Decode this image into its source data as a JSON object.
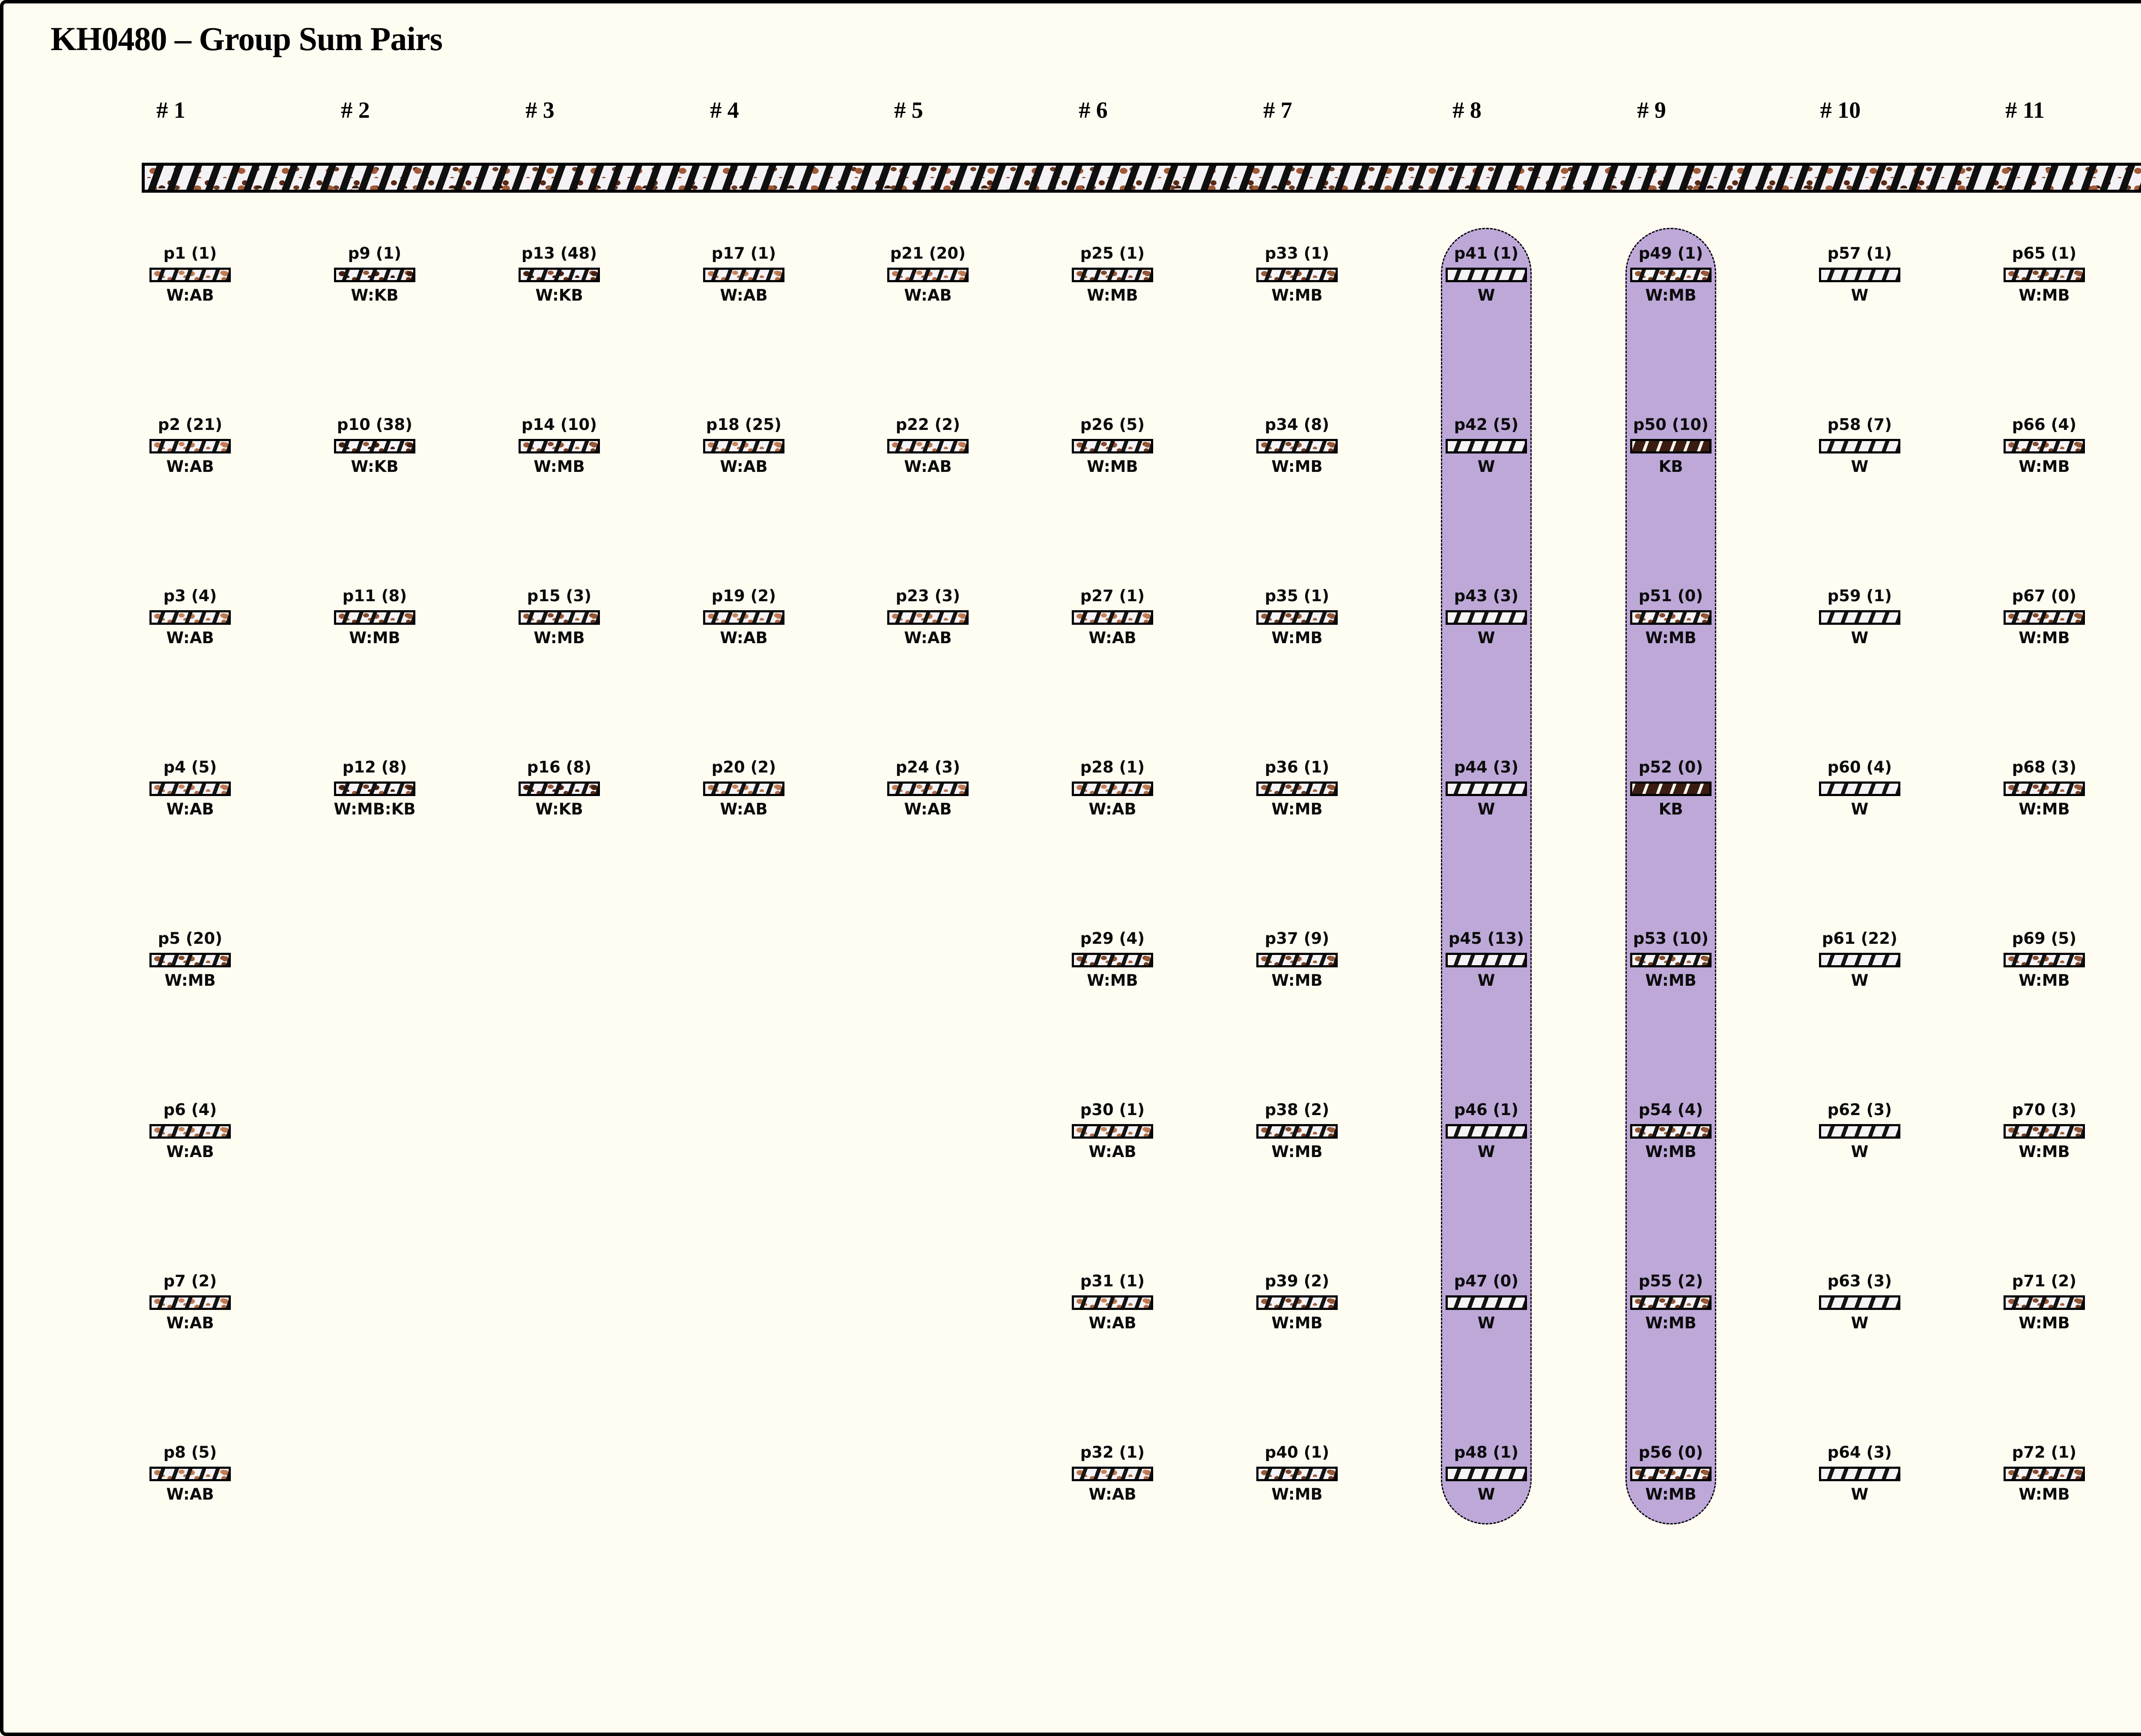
{
  "title": "KH0480 – Group Sum Pairs",
  "colors": {
    "canvas_background": "#fffdf2",
    "highlight_column": "#bda8d8",
    "kb_fill": "#3a1c10",
    "ab_spot": "#bf7a52",
    "mb_spot": "#9a5936",
    "kb_spot": "#4a2212",
    "faded_fill": "#fcefe7",
    "faded_text": "#c9c3ae"
  },
  "columns": [
    {
      "header": "# 1",
      "highlighted": false,
      "items": [
        {
          "label": "p1 (1)",
          "tag": "W:AB",
          "faded": false
        },
        {
          "label": "p2 (21)",
          "tag": "W:AB",
          "faded": false
        },
        {
          "label": "p3 (4)",
          "tag": "W:AB",
          "faded": false
        },
        {
          "label": "p4 (5)",
          "tag": "W:AB",
          "faded": false
        },
        {
          "label": "p5 (20)",
          "tag": "W:MB",
          "faded": false
        },
        {
          "label": "p6 (4)",
          "tag": "W:AB",
          "faded": false
        },
        {
          "label": "p7 (2)",
          "tag": "W:AB",
          "faded": false
        },
        {
          "label": "p8 (5)",
          "tag": "W:AB",
          "faded": false
        }
      ]
    },
    {
      "header": "# 2",
      "highlighted": false,
      "items": [
        {
          "label": "p9 (1)",
          "tag": "W:KB",
          "faded": false
        },
        {
          "label": "p10 (38)",
          "tag": "W:KB",
          "faded": false
        },
        {
          "label": "p11 (8)",
          "tag": "W:MB",
          "faded": false
        },
        {
          "label": "p12 (8)",
          "tag": "W:MB:KB",
          "faded": false
        }
      ]
    },
    {
      "header": "# 3",
      "highlighted": false,
      "items": [
        {
          "label": "p13 (48)",
          "tag": "W:KB",
          "faded": false
        },
        {
          "label": "p14 (10)",
          "tag": "W:MB",
          "faded": false
        },
        {
          "label": "p15 (3)",
          "tag": "W:MB",
          "faded": false
        },
        {
          "label": "p16 (8)",
          "tag": "W:KB",
          "faded": false
        }
      ]
    },
    {
      "header": "# 4",
      "highlighted": false,
      "items": [
        {
          "label": "p17 (1)",
          "tag": "W:AB",
          "faded": false
        },
        {
          "label": "p18 (25)",
          "tag": "W:AB",
          "faded": false
        },
        {
          "label": "p19 (2)",
          "tag": "W:AB",
          "faded": false
        },
        {
          "label": "p20 (2)",
          "tag": "W:AB",
          "faded": false
        }
      ]
    },
    {
      "header": "# 5",
      "highlighted": false,
      "items": [
        {
          "label": "p21 (20)",
          "tag": "W:AB",
          "faded": false
        },
        {
          "label": "p22 (2)",
          "tag": "W:AB",
          "faded": false
        },
        {
          "label": "p23 (3)",
          "tag": "W:AB",
          "faded": false
        },
        {
          "label": "p24 (3)",
          "tag": "W:AB",
          "faded": false
        }
      ]
    },
    {
      "header": "# 6",
      "highlighted": false,
      "items": [
        {
          "label": "p25 (1)",
          "tag": "W:MB",
          "faded": false
        },
        {
          "label": "p26 (5)",
          "tag": "W:MB",
          "faded": false
        },
        {
          "label": "p27 (1)",
          "tag": "W:AB",
          "faded": false
        },
        {
          "label": "p28 (1)",
          "tag": "W:AB",
          "faded": false
        },
        {
          "label": "p29 (4)",
          "tag": "W:MB",
          "faded": false
        },
        {
          "label": "p30 (1)",
          "tag": "W:AB",
          "faded": false
        },
        {
          "label": "p31 (1)",
          "tag": "W:AB",
          "faded": false
        },
        {
          "label": "p32 (1)",
          "tag": "W:AB",
          "faded": false
        }
      ]
    },
    {
      "header": "# 7",
      "highlighted": false,
      "items": [
        {
          "label": "p33 (1)",
          "tag": "W:MB",
          "faded": false
        },
        {
          "label": "p34 (8)",
          "tag": "W:MB",
          "faded": false
        },
        {
          "label": "p35 (1)",
          "tag": "W:MB",
          "faded": false
        },
        {
          "label": "p36 (1)",
          "tag": "W:MB",
          "faded": false
        },
        {
          "label": "p37 (9)",
          "tag": "W:MB",
          "faded": false
        },
        {
          "label": "p38 (2)",
          "tag": "W:MB",
          "faded": false
        },
        {
          "label": "p39 (2)",
          "tag": "W:MB",
          "faded": false
        },
        {
          "label": "p40 (1)",
          "tag": "W:MB",
          "faded": false
        }
      ]
    },
    {
      "header": "# 8",
      "highlighted": true,
      "items": [
        {
          "label": "p41 (1)",
          "tag": "W",
          "faded": false
        },
        {
          "label": "p42 (5)",
          "tag": "W",
          "faded": false
        },
        {
          "label": "p43 (3)",
          "tag": "W",
          "faded": false
        },
        {
          "label": "p44 (3)",
          "tag": "W",
          "faded": false
        },
        {
          "label": "p45 (13)",
          "tag": "W",
          "faded": false
        },
        {
          "label": "p46 (1)",
          "tag": "W",
          "faded": false
        },
        {
          "label": "p47 (0)",
          "tag": "W",
          "faded": false
        },
        {
          "label": "p48 (1)",
          "tag": "W",
          "faded": false
        }
      ]
    },
    {
      "header": "# 9",
      "highlighted": true,
      "items": [
        {
          "label": "p49 (1)",
          "tag": "W:MB",
          "faded": false
        },
        {
          "label": "p50 (10)",
          "tag": "KB",
          "faded": false
        },
        {
          "label": "p51 (0)",
          "tag": "W:MB",
          "faded": false
        },
        {
          "label": "p52 (0)",
          "tag": "KB",
          "faded": false
        },
        {
          "label": "p53 (10)",
          "tag": "W:MB",
          "faded": false
        },
        {
          "label": "p54 (4)",
          "tag": "W:MB",
          "faded": false
        },
        {
          "label": "p55 (2)",
          "tag": "W:MB",
          "faded": false
        },
        {
          "label": "p56 (0)",
          "tag": "W:MB",
          "faded": false
        }
      ]
    },
    {
      "header": "# 10",
      "highlighted": false,
      "items": [
        {
          "label": "p57 (1)",
          "tag": "W",
          "faded": false
        },
        {
          "label": "p58 (7)",
          "tag": "W",
          "faded": false
        },
        {
          "label": "p59 (1)",
          "tag": "W",
          "faded": false
        },
        {
          "label": "p60 (4)",
          "tag": "W",
          "faded": false
        },
        {
          "label": "p61 (22)",
          "tag": "W",
          "faded": false
        },
        {
          "label": "p62 (3)",
          "tag": "W",
          "faded": false
        },
        {
          "label": "p63 (3)",
          "tag": "W",
          "faded": false
        },
        {
          "label": "p64 (3)",
          "tag": "W",
          "faded": false
        }
      ]
    },
    {
      "header": "# 11",
      "highlighted": false,
      "items": [
        {
          "label": "p65 (1)",
          "tag": "W:MB",
          "faded": false
        },
        {
          "label": "p66 (4)",
          "tag": "W:MB",
          "faded": false
        },
        {
          "label": "p67 (0)",
          "tag": "W:MB",
          "faded": false
        },
        {
          "label": "p68 (3)",
          "tag": "W:MB",
          "faded": false
        },
        {
          "label": "p69 (5)",
          "tag": "W:MB",
          "faded": false
        },
        {
          "label": "p70 (3)",
          "tag": "W:MB",
          "faded": false
        },
        {
          "label": "p71 (2)",
          "tag": "W:MB",
          "faded": false
        },
        {
          "label": "p72 (1)",
          "tag": "W:MB",
          "faded": false
        }
      ]
    },
    {
      "header": "# 12",
      "highlighted": false,
      "items": [
        {
          "label": "p73 (0)",
          "tag": "PK",
          "faded": true
        }
      ]
    }
  ]
}
